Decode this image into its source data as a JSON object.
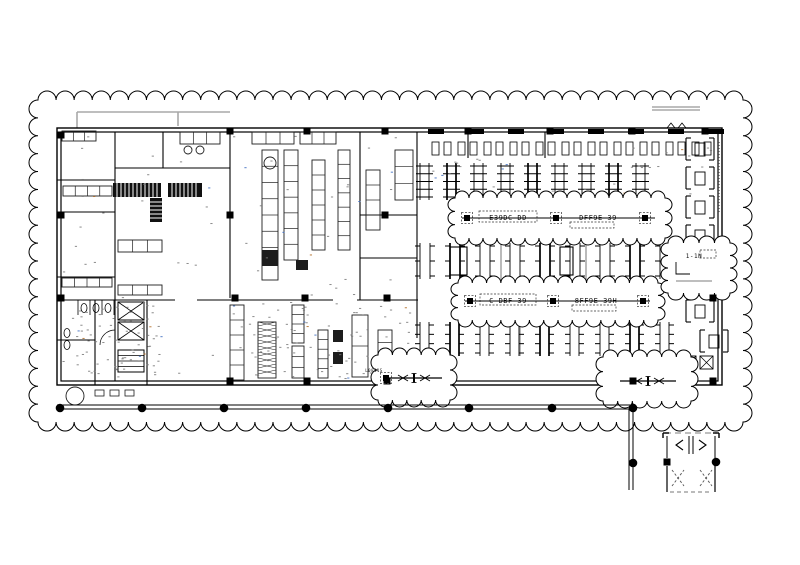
{
  "drawing": {
    "type": "architectural-floor-plan",
    "annotations": {
      "rev_note_1a": "E39DC-DD",
      "rev_note_1b": "DFF9E-39",
      "rev_note_2a": "C-DBF-39",
      "rev_note_2b": "8FF9E-39H",
      "side_note": "1-1N",
      "door_note": "L0841S"
    },
    "colors": {
      "ink": "#000000",
      "equip": "#1d1d1d",
      "gray": "#a8a8a8",
      "midgray": "#666666",
      "speck_blue": "#3a6abf",
      "speck_orange": "#b06820"
    },
    "geometry": {
      "outer_cloud": {
        "x": 38,
        "y": 100,
        "w": 705,
        "h": 322,
        "r": 9
      },
      "rev_clouds": [
        {
          "x": 455,
          "y": 198,
          "w": 210,
          "h": 40,
          "r": 7
        },
        {
          "x": 458,
          "y": 283,
          "w": 200,
          "h": 37,
          "r": 7
        },
        {
          "x": 378,
          "y": 355,
          "w": 72,
          "h": 45,
          "r": 7
        },
        {
          "x": 603,
          "y": 357,
          "w": 88,
          "h": 44,
          "r": 7
        },
        {
          "x": 668,
          "y": 243,
          "w": 62,
          "h": 50,
          "r": 7
        }
      ],
      "building": {
        "x1": 57,
        "y1": 128,
        "x2": 722,
        "y2": 385
      },
      "walls": [
        [
          115,
          132,
          115,
          381
        ],
        [
          163,
          132,
          163,
          168
        ],
        [
          115,
          168,
          230,
          168
        ],
        [
          230,
          132,
          230,
          298
        ],
        [
          57,
          180,
          115,
          180
        ],
        [
          57,
          212,
          115,
          212
        ],
        [
          57,
          277,
          115,
          277
        ],
        [
          57,
          300,
          418,
          300
        ],
        [
          417,
          132,
          417,
          385
        ],
        [
          360,
          132,
          360,
          300
        ],
        [
          360,
          215,
          417,
          215
        ],
        [
          360,
          258,
          417,
          258
        ],
        [
          95,
          300,
          95,
          385
        ],
        [
          147,
          300,
          147,
          385
        ],
        [
          57,
          340,
          95,
          340
        ],
        [
          468,
          132,
          468,
          158
        ],
        [
          545,
          132,
          545,
          158
        ]
      ],
      "door_gaps": [
        [
          175,
          295,
          22,
          10
        ],
        [
          333,
          295,
          24,
          10
        ],
        [
          413,
          338,
          9,
          26
        ]
      ],
      "lifts": [
        [
          118,
          302,
          26,
          18
        ],
        [
          118,
          322,
          26,
          18
        ],
        [
          118,
          350,
          26,
          22
        ]
      ],
      "col_squares": [
        [
          230,
          131
        ],
        [
          307,
          131
        ],
        [
          385,
          131
        ],
        [
          468,
          131
        ],
        [
          550,
          131
        ],
        [
          632,
          131
        ],
        [
          705,
          131
        ],
        [
          61,
          135
        ],
        [
          61,
          215
        ],
        [
          61,
          298
        ],
        [
          230,
          215
        ],
        [
          385,
          215
        ],
        [
          235,
          298
        ],
        [
          305,
          298
        ],
        [
          387,
          298
        ],
        [
          713,
          298
        ],
        [
          230,
          381
        ],
        [
          307,
          381
        ],
        [
          387,
          381
        ],
        [
          633,
          381
        ],
        [
          713,
          381
        ],
        [
          667,
          462
        ]
      ],
      "dashed_squares": [
        [
          467,
          218
        ],
        [
          556,
          218
        ],
        [
          645,
          218
        ],
        [
          470,
          301
        ],
        [
          553,
          301
        ],
        [
          643,
          301
        ],
        [
          386,
          378
        ]
      ],
      "dots": [
        [
          60,
          408
        ],
        [
          142,
          408
        ],
        [
          224,
          408
        ],
        [
          306,
          408
        ],
        [
          388,
          408
        ],
        [
          469,
          408
        ],
        [
          552,
          408
        ],
        [
          633,
          408
        ],
        [
          633,
          463
        ],
        [
          716,
          462
        ]
      ],
      "colonnade": {
        "x1": 57,
        "x2": 633,
        "y": 405,
        "drop_x": 631,
        "drop_y2": 490
      },
      "banks": [
        {
          "x0": 420,
          "y": 163,
          "h": 37,
          "cols": 9,
          "step": 27,
          "gap": 9,
          "rungs": 5,
          "full": true
        },
        {
          "x0": 420,
          "y": 243,
          "h": 36,
          "cols": 9,
          "step": 30,
          "gap": 10,
          "rungs": 3,
          "full": false
        },
        {
          "x0": 420,
          "y": 322,
          "h": 34,
          "cols": 9,
          "step": 30,
          "gap": 9,
          "rungs": 4,
          "full": false
        }
      ],
      "bank_boxes": [
        [
          450,
          247,
          17,
          28
        ],
        [
          560,
          247,
          13,
          28
        ]
      ],
      "window_seats": {
        "x0": 432,
        "y": 142,
        "count": 11,
        "step": 26
      },
      "booths": [
        [
          686,
          138
        ],
        [
          686,
          167
        ],
        [
          686,
          196
        ],
        [
          686,
          225
        ],
        [
          686,
          300
        ],
        [
          700,
          330
        ]
      ],
      "hatch_boxes": [
        [
          683,
          356,
          13,
          13
        ],
        [
          700,
          356,
          13,
          13
        ]
      ],
      "equip_runs": [
        {
          "x": 62,
          "y": 131,
          "w": 34,
          "h": 10,
          "n": 3,
          "v": false
        },
        {
          "x": 63,
          "y": 186,
          "w": 49,
          "h": 10,
          "n": 4,
          "v": false
        },
        {
          "x": 62,
          "y": 278,
          "w": 50,
          "h": 9,
          "n": 4,
          "v": false
        },
        {
          "x": 118,
          "y": 240,
          "w": 44,
          "h": 12,
          "n": 3,
          "v": false
        },
        {
          "x": 118,
          "y": 285,
          "w": 44,
          "h": 10,
          "n": 3,
          "v": false
        },
        {
          "x": 180,
          "y": 132,
          "w": 40,
          "h": 12,
          "n": 3,
          "v": false
        },
        {
          "x": 252,
          "y": 132,
          "w": 42,
          "h": 12,
          "n": 3,
          "v": false
        },
        {
          "x": 300,
          "y": 132,
          "w": 36,
          "h": 12,
          "n": 3,
          "v": false
        },
        {
          "x": 262,
          "y": 150,
          "w": 16,
          "h": 130,
          "n": 8,
          "v": true
        },
        {
          "x": 284,
          "y": 150,
          "w": 14,
          "h": 110,
          "n": 7,
          "v": true
        },
        {
          "x": 312,
          "y": 160,
          "w": 13,
          "h": 90,
          "n": 6,
          "v": true
        },
        {
          "x": 338,
          "y": 150,
          "w": 12,
          "h": 100,
          "n": 7,
          "v": true
        },
        {
          "x": 366,
          "y": 170,
          "w": 14,
          "h": 60,
          "n": 4,
          "v": true
        },
        {
          "x": 395,
          "y": 150,
          "w": 18,
          "h": 50,
          "n": 3,
          "v": true
        },
        {
          "x": 230,
          "y": 305,
          "w": 14,
          "h": 75,
          "n": 5,
          "v": true
        },
        {
          "x": 292,
          "y": 305,
          "w": 12,
          "h": 38,
          "n": 4,
          "v": true
        },
        {
          "x": 292,
          "y": 346,
          "w": 12,
          "h": 32,
          "n": 3,
          "v": true
        },
        {
          "x": 318,
          "y": 330,
          "w": 10,
          "h": 48,
          "n": 5,
          "v": true
        },
        {
          "x": 352,
          "y": 315,
          "w": 16,
          "h": 62,
          "n": 2,
          "v": true
        },
        {
          "x": 378,
          "y": 330,
          "w": 14,
          "h": 50,
          "n": 4,
          "v": true
        }
      ],
      "dark_cells": [
        [
          262,
          250,
          16,
          16
        ],
        [
          333,
          330,
          10,
          12
        ],
        [
          333,
          352,
          10,
          12
        ],
        [
          296,
          260,
          12,
          10
        ]
      ],
      "shelves": [
        [
          113,
          183,
          48,
          14
        ],
        [
          168,
          183,
          34,
          14
        ],
        [
          150,
          198,
          12,
          24
        ]
      ],
      "hatch_island": [
        258,
        322,
        18,
        56
      ],
      "circles": [
        {
          "x": 270,
          "y": 163,
          "r": 6
        },
        {
          "x": 188,
          "y": 150,
          "r": 4
        },
        {
          "x": 200,
          "y": 150,
          "r": 4
        },
        {
          "x": 75,
          "y": 396,
          "r": 9
        }
      ],
      "wc_ovals": [
        [
          84,
          308
        ],
        [
          96,
          308
        ],
        [
          108,
          308
        ],
        [
          67,
          333
        ],
        [
          67,
          345
        ]
      ],
      "stall_lines": [
        [
          78,
          300,
          78,
          315
        ],
        [
          90,
          300,
          90,
          315
        ],
        [
          102,
          300,
          102,
          315
        ],
        [
          114,
          300,
          114,
          315
        ]
      ],
      "gray_lines": [
        [
          77,
          128,
          77,
          112
        ],
        [
          77,
          112,
          230,
          112
        ],
        [
          178,
          112,
          178,
          126
        ],
        [
          652,
          107,
          700,
          107
        ],
        [
          652,
          110,
          700,
          110
        ],
        [
          501,
          243,
          501,
          280
        ],
        [
          586,
          243,
          586,
          280
        ],
        [
          520,
          322,
          520,
          356
        ]
      ],
      "top_dashes": {
        "x0": 428,
        "y": 129,
        "count": 8,
        "step": 40,
        "w": 16,
        "h": 5
      },
      "benches_out": [
        [
          95,
          390
        ],
        [
          110,
          390
        ],
        [
          125,
          390
        ]
      ],
      "vestibule": {
        "x1": 667,
        "x2": 715,
        "ytop": 433,
        "ymid": 462,
        "ybot": 492
      }
    }
  }
}
